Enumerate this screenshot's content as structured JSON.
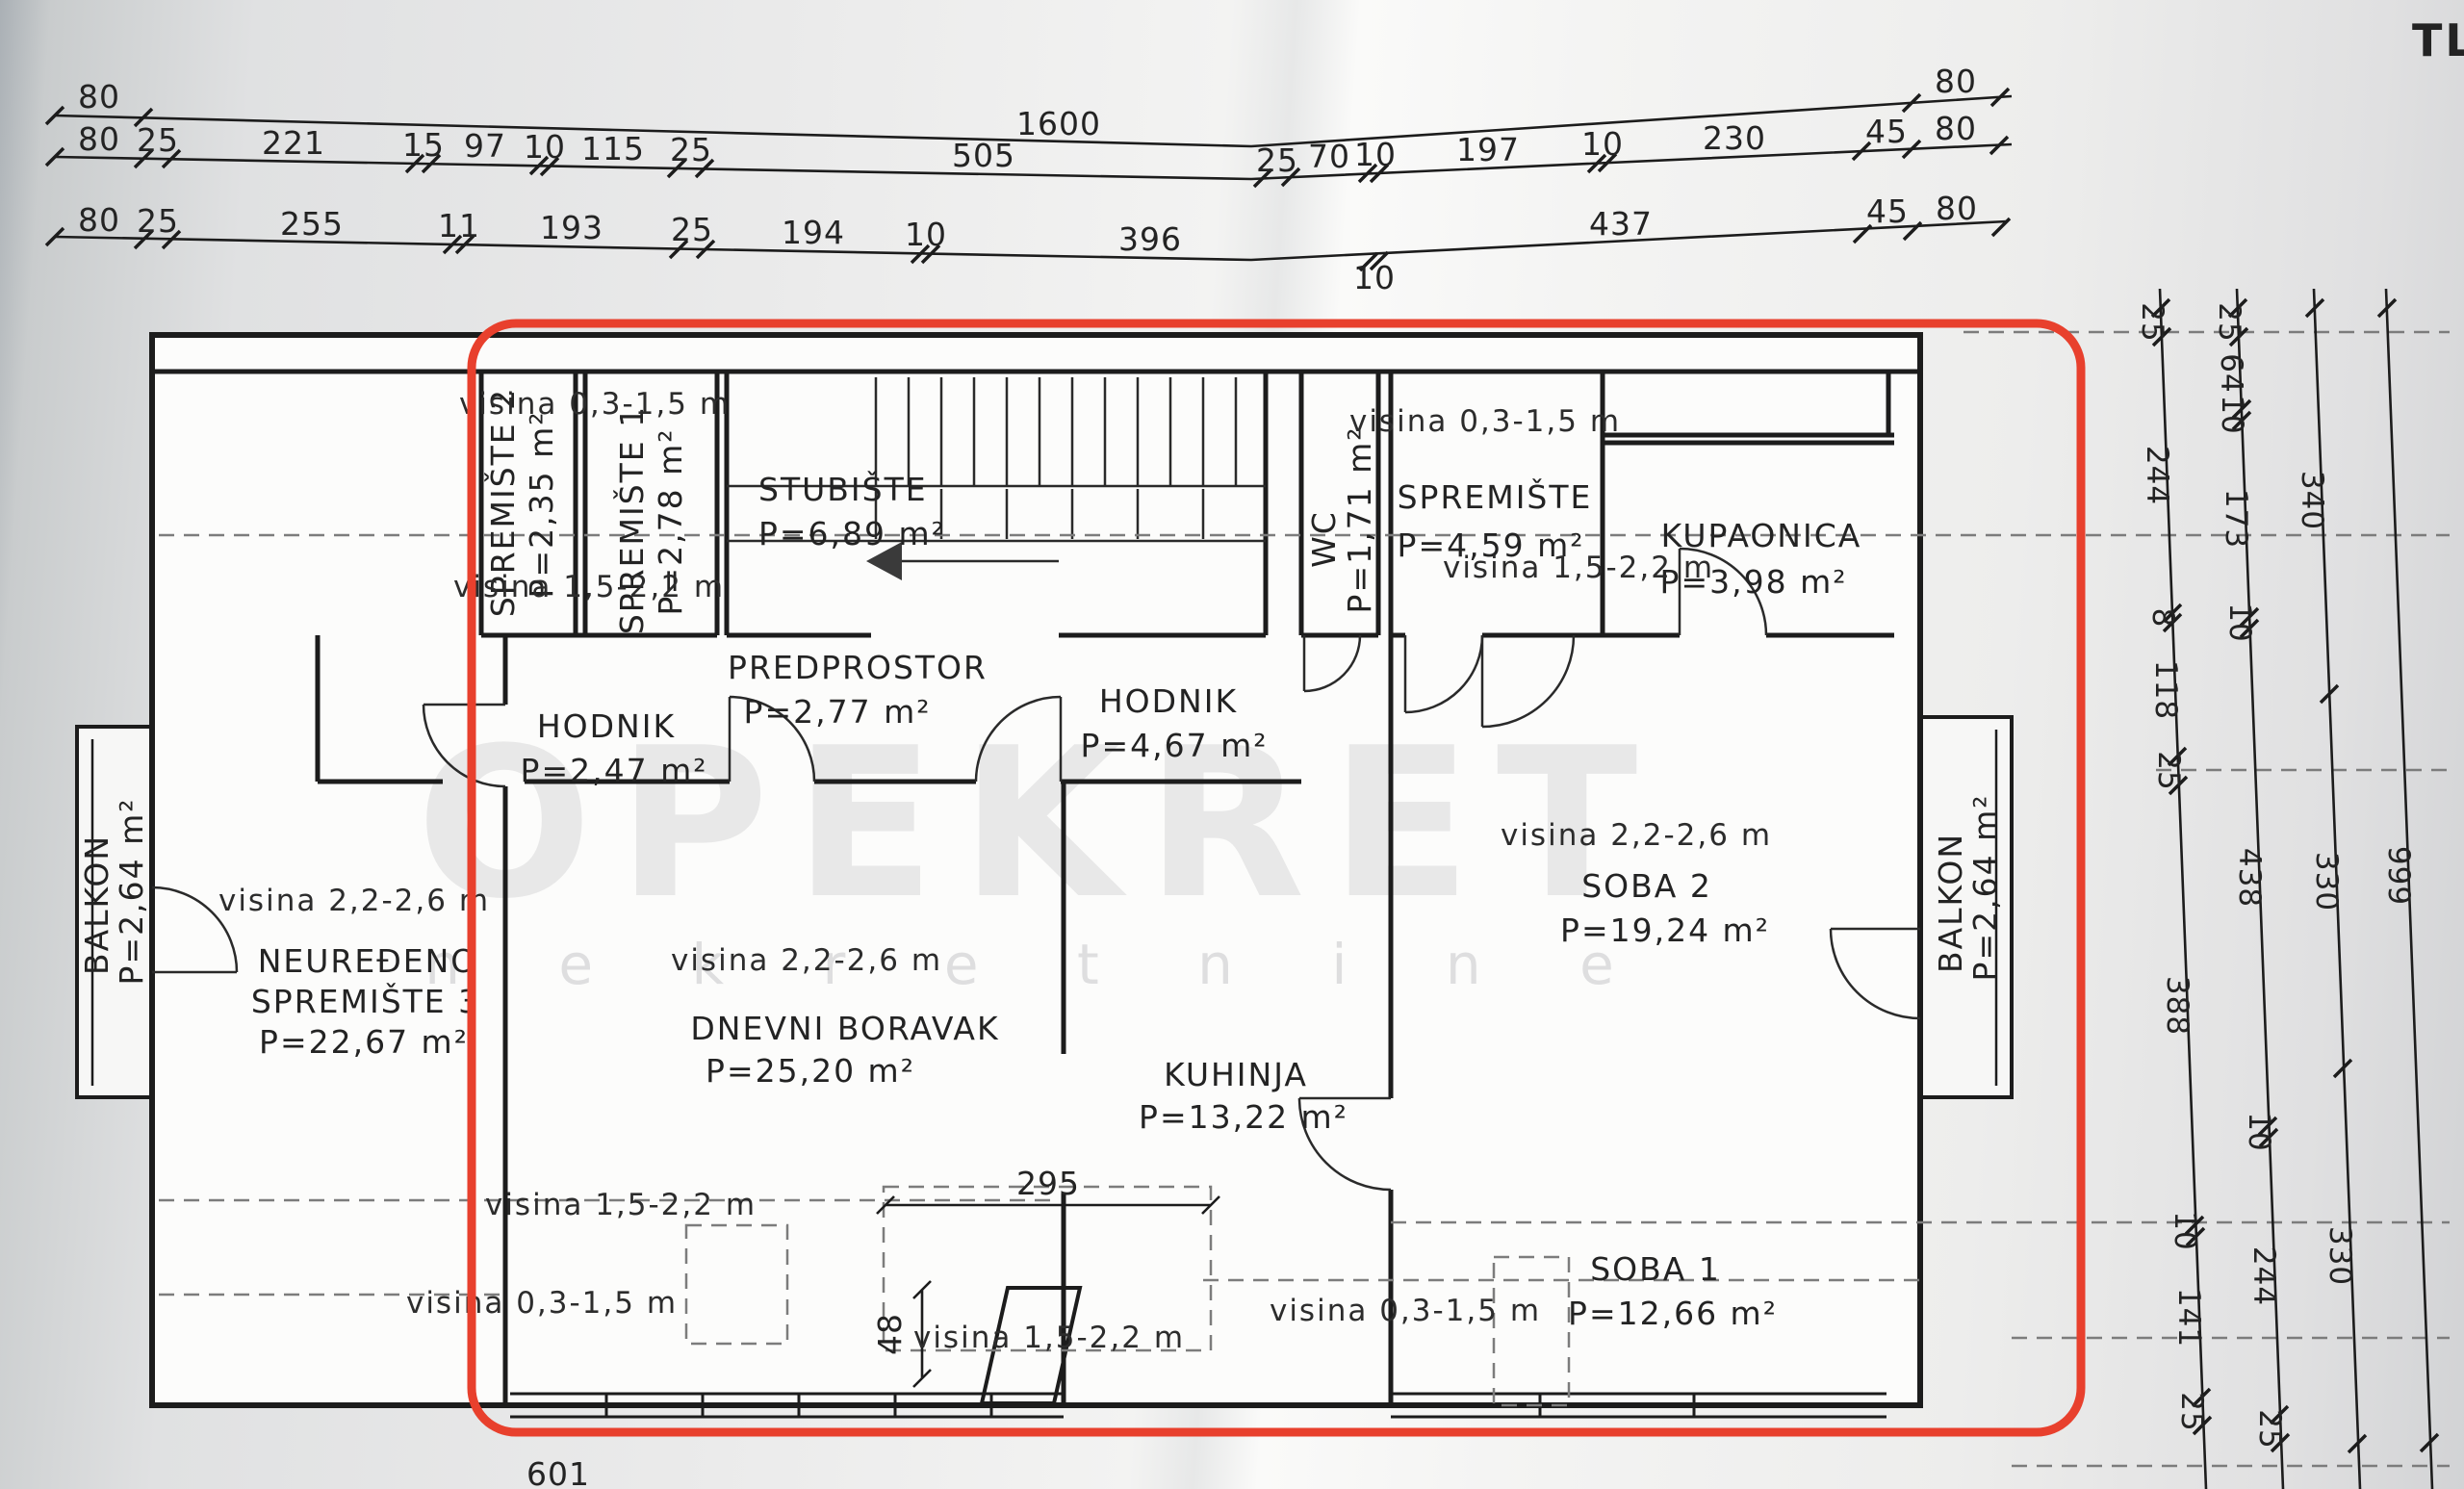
{
  "sheet": {
    "corner_title": "TLO",
    "watermark_brand": "OPEKRET",
    "watermark_sub": "n e k r e t n i n e",
    "highlight_color": "#e8402d"
  },
  "top_dims": {
    "row1": {
      "d1": "80",
      "d2": "1600",
      "d3": "80"
    },
    "row2": {
      "d1": "80",
      "d2": "25",
      "d3": "221",
      "d4": "15",
      "d5": "97",
      "d6": "10",
      "d7": "115",
      "d8": "25",
      "d9": "505",
      "d10": "25",
      "d11": "70",
      "d12": "10",
      "d13": "197",
      "d14": "10",
      "d15": "230",
      "d16": "45",
      "d17": "80"
    },
    "row3": {
      "d1": "80",
      "d2": "25",
      "d3": "255",
      "d4": "11",
      "d5": "193",
      "d6": "25",
      "d7": "194",
      "d8": "10",
      "d9": "396",
      "d10": "10",
      "d11": "437",
      "d12": "45",
      "d13": "80"
    }
  },
  "right_dims": {
    "c1": {
      "d1": "25",
      "d2": "244",
      "d3": "8",
      "d4": "118",
      "d5": "25",
      "d6": "388",
      "d7": "10",
      "d8": "141",
      "d9": "25"
    },
    "c2": {
      "d1": "25",
      "d2": "64",
      "d3": "10",
      "d4": "173",
      "d5": "10",
      "d6": "438",
      "d7": "10",
      "d8": "244",
      "d9": "25"
    },
    "c3": {
      "d1": "340",
      "d2": "330",
      "d3": "330"
    },
    "c4": {
      "d1": "999"
    }
  },
  "inner_dims": {
    "w295": "295",
    "h48": "48",
    "b601": "601"
  },
  "rooms": {
    "spremiste2": {
      "name": "SPREMIŠTE 2",
      "area": "P=2,35 m²"
    },
    "spremiste1": {
      "name": "SPREMIŠTE 1",
      "area": "P=2,78 m²"
    },
    "stubiste": {
      "name": "STUBIŠTE",
      "area": "P=6,89 m²"
    },
    "wc": {
      "name": "WC",
      "area": "P=1,71 m²"
    },
    "spremiste": {
      "name": "SPREMIŠTE",
      "area": "P=4,59 m²"
    },
    "kupaonica": {
      "name": "KUPAONICA",
      "area": "P=3,98 m²"
    },
    "hodnik1": {
      "name": "HODNIK",
      "area": "P=2,47 m²"
    },
    "predprostor": {
      "name": "PREDPROSTOR",
      "area": "P=2,77 m²"
    },
    "hodnik2": {
      "name": "HODNIK",
      "area": "P=4,67 m²"
    },
    "soba2": {
      "name": "SOBA 2",
      "area": "P=19,24 m²"
    },
    "neuredjeno": {
      "line1": "NEUREĐENO",
      "line2": "SPREMIŠTE 3",
      "area": "P=22,67 m²"
    },
    "dnevni": {
      "name": "DNEVNI BORAVAK",
      "area": "P=25,20 m²"
    },
    "kuhinja": {
      "name": "KUHINJA",
      "area": "P=13,22 m²"
    },
    "soba1": {
      "name": "SOBA 1",
      "area": "P=12,66 m²"
    },
    "balkon_l": {
      "name": "BALKON",
      "area": "P=2,64 m²"
    },
    "balkon_r": {
      "name": "BALKON",
      "area": "P=2,64 m²"
    }
  },
  "heights": {
    "h1": "visina 0,3-1,5 m",
    "h2": "visina 1,5-2,2 m",
    "h3": "visina 0,3-1,5 m",
    "h4": "visina 1,5-2,2 m",
    "h5": "visina 2,2-2,6 m",
    "h6": "visina 2,2-2,6 m",
    "h7": "visina 2,2-2,6 m",
    "h8": "visina 1,5-2,2 m",
    "h9": "visina 0,3-1,5 m",
    "h10": "visina 1,5-2,2 m",
    "h11": "visina 0,3-1,5 m"
  }
}
